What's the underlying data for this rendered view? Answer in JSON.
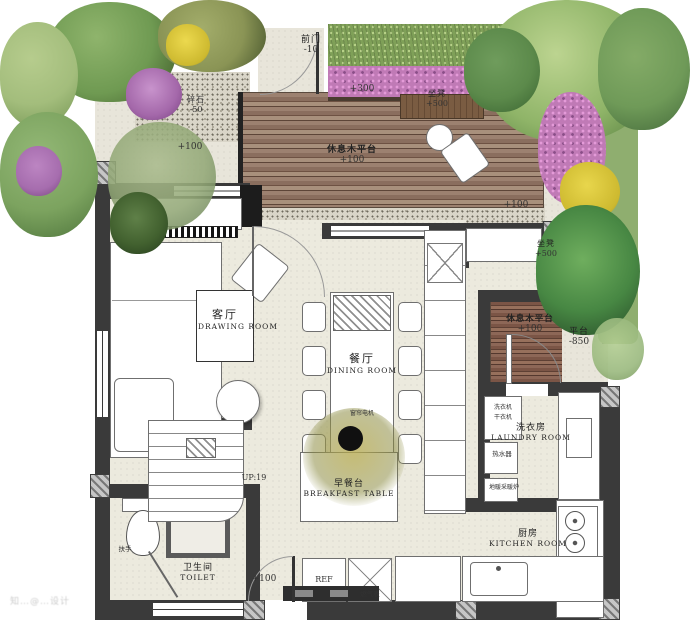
{
  "watermark": "知…@…设计",
  "outdoor": {
    "front_door_zh": "前门",
    "front_door_level": "-10",
    "planter_level": "+300",
    "bench_top_zh": "坐凳",
    "bench_top_level": "+500",
    "deck_top_zh": "休息木平台",
    "deck_top_level": "+100",
    "court_left_level": "+100",
    "gravel_zh": "碎石",
    "gravel_level": "-50",
    "court_right_level": "+100",
    "bench_right_zh": "坐凳",
    "bench_right_level": "+500",
    "deck_right_zh": "休息木平台",
    "deck_right_level": "+100",
    "platform_zh": "平台",
    "platform_level": "-850",
    "rear_door_level": "+100"
  },
  "rooms": {
    "drawing_zh": "客厅",
    "drawing_en": "DRAWING ROOM",
    "dining_zh": "餐厅",
    "dining_en": "DINING ROOM",
    "breakfast_zh": "早餐台",
    "breakfast_en": "BREAKFAST TABLE",
    "laundry_zh": "洗衣房",
    "laundry_en": "LAUNDRY ROOM",
    "kitchen_zh": "厨房",
    "kitchen_en": "KITCHEN ROOM",
    "toilet_zh": "卫生间",
    "toilet_en": "TOILET"
  },
  "fixtures": {
    "washer": "洗衣机",
    "dryer": "干衣机",
    "water_heater": "热水器",
    "heating_unit": "地暖采暖炉",
    "curtain_motor": "窗帘电机",
    "fridge": "REF",
    "gas_meter": "燃气表",
    "handrail": "扶手",
    "stairs_up": "UP:19"
  }
}
